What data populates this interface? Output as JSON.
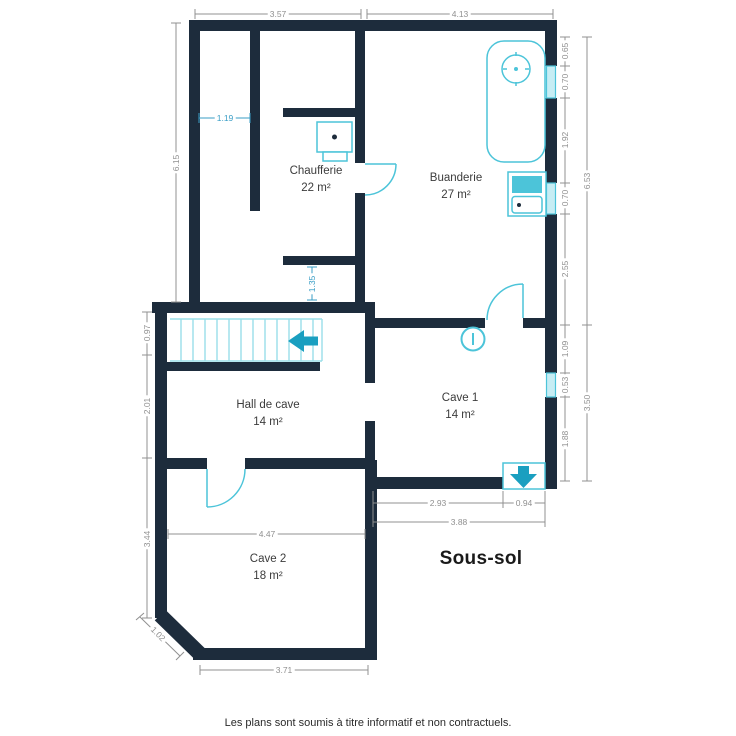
{
  "title": "Sous-sol",
  "footer": "Les plans sont soumis à titre informatif et non contractuels.",
  "rooms": [
    {
      "name": "Chaufferie",
      "area": "22 m²"
    },
    {
      "name": "Buanderie",
      "area": "27 m²"
    },
    {
      "name": "Hall de cave",
      "area": "14 m²"
    },
    {
      "name": "Cave 1",
      "area": "14 m²"
    },
    {
      "name": "Cave 2",
      "area": "18 m²"
    }
  ],
  "dims": {
    "top": [
      "3.57",
      "4.13"
    ],
    "left": [
      "6.15",
      "0.97",
      "2.01",
      "3.44"
    ],
    "right": [
      "0.65",
      "0.70",
      "1.92",
      "0.70",
      "2.55",
      "6.53",
      "1.09",
      "0.53",
      "1.88",
      "3.50"
    ],
    "bottom": [
      "2.93",
      "0.94",
      "3.88",
      "3.71",
      "1.02"
    ],
    "interior": [
      "1.19",
      "1.35",
      "4.47"
    ]
  },
  "fixtures": [
    "water-heater",
    "boiler",
    "laundry-sink",
    "staircase",
    "stairs-direction-arrow",
    "stairs-down-hatch",
    "info-symbol",
    "door-chaufferie",
    "door-cave1",
    "door-cave2",
    "window"
  ],
  "colors": {
    "wall": "#1d2c3c",
    "fixture": "#4cc4d9",
    "accent": "#1a9fc0",
    "stair_tread": "#9adfe9",
    "dim_gray": "#909090",
    "dim_blue": "#3a9ec6",
    "window_fill": "#c6edf4",
    "text": "#3c3c3c"
  }
}
